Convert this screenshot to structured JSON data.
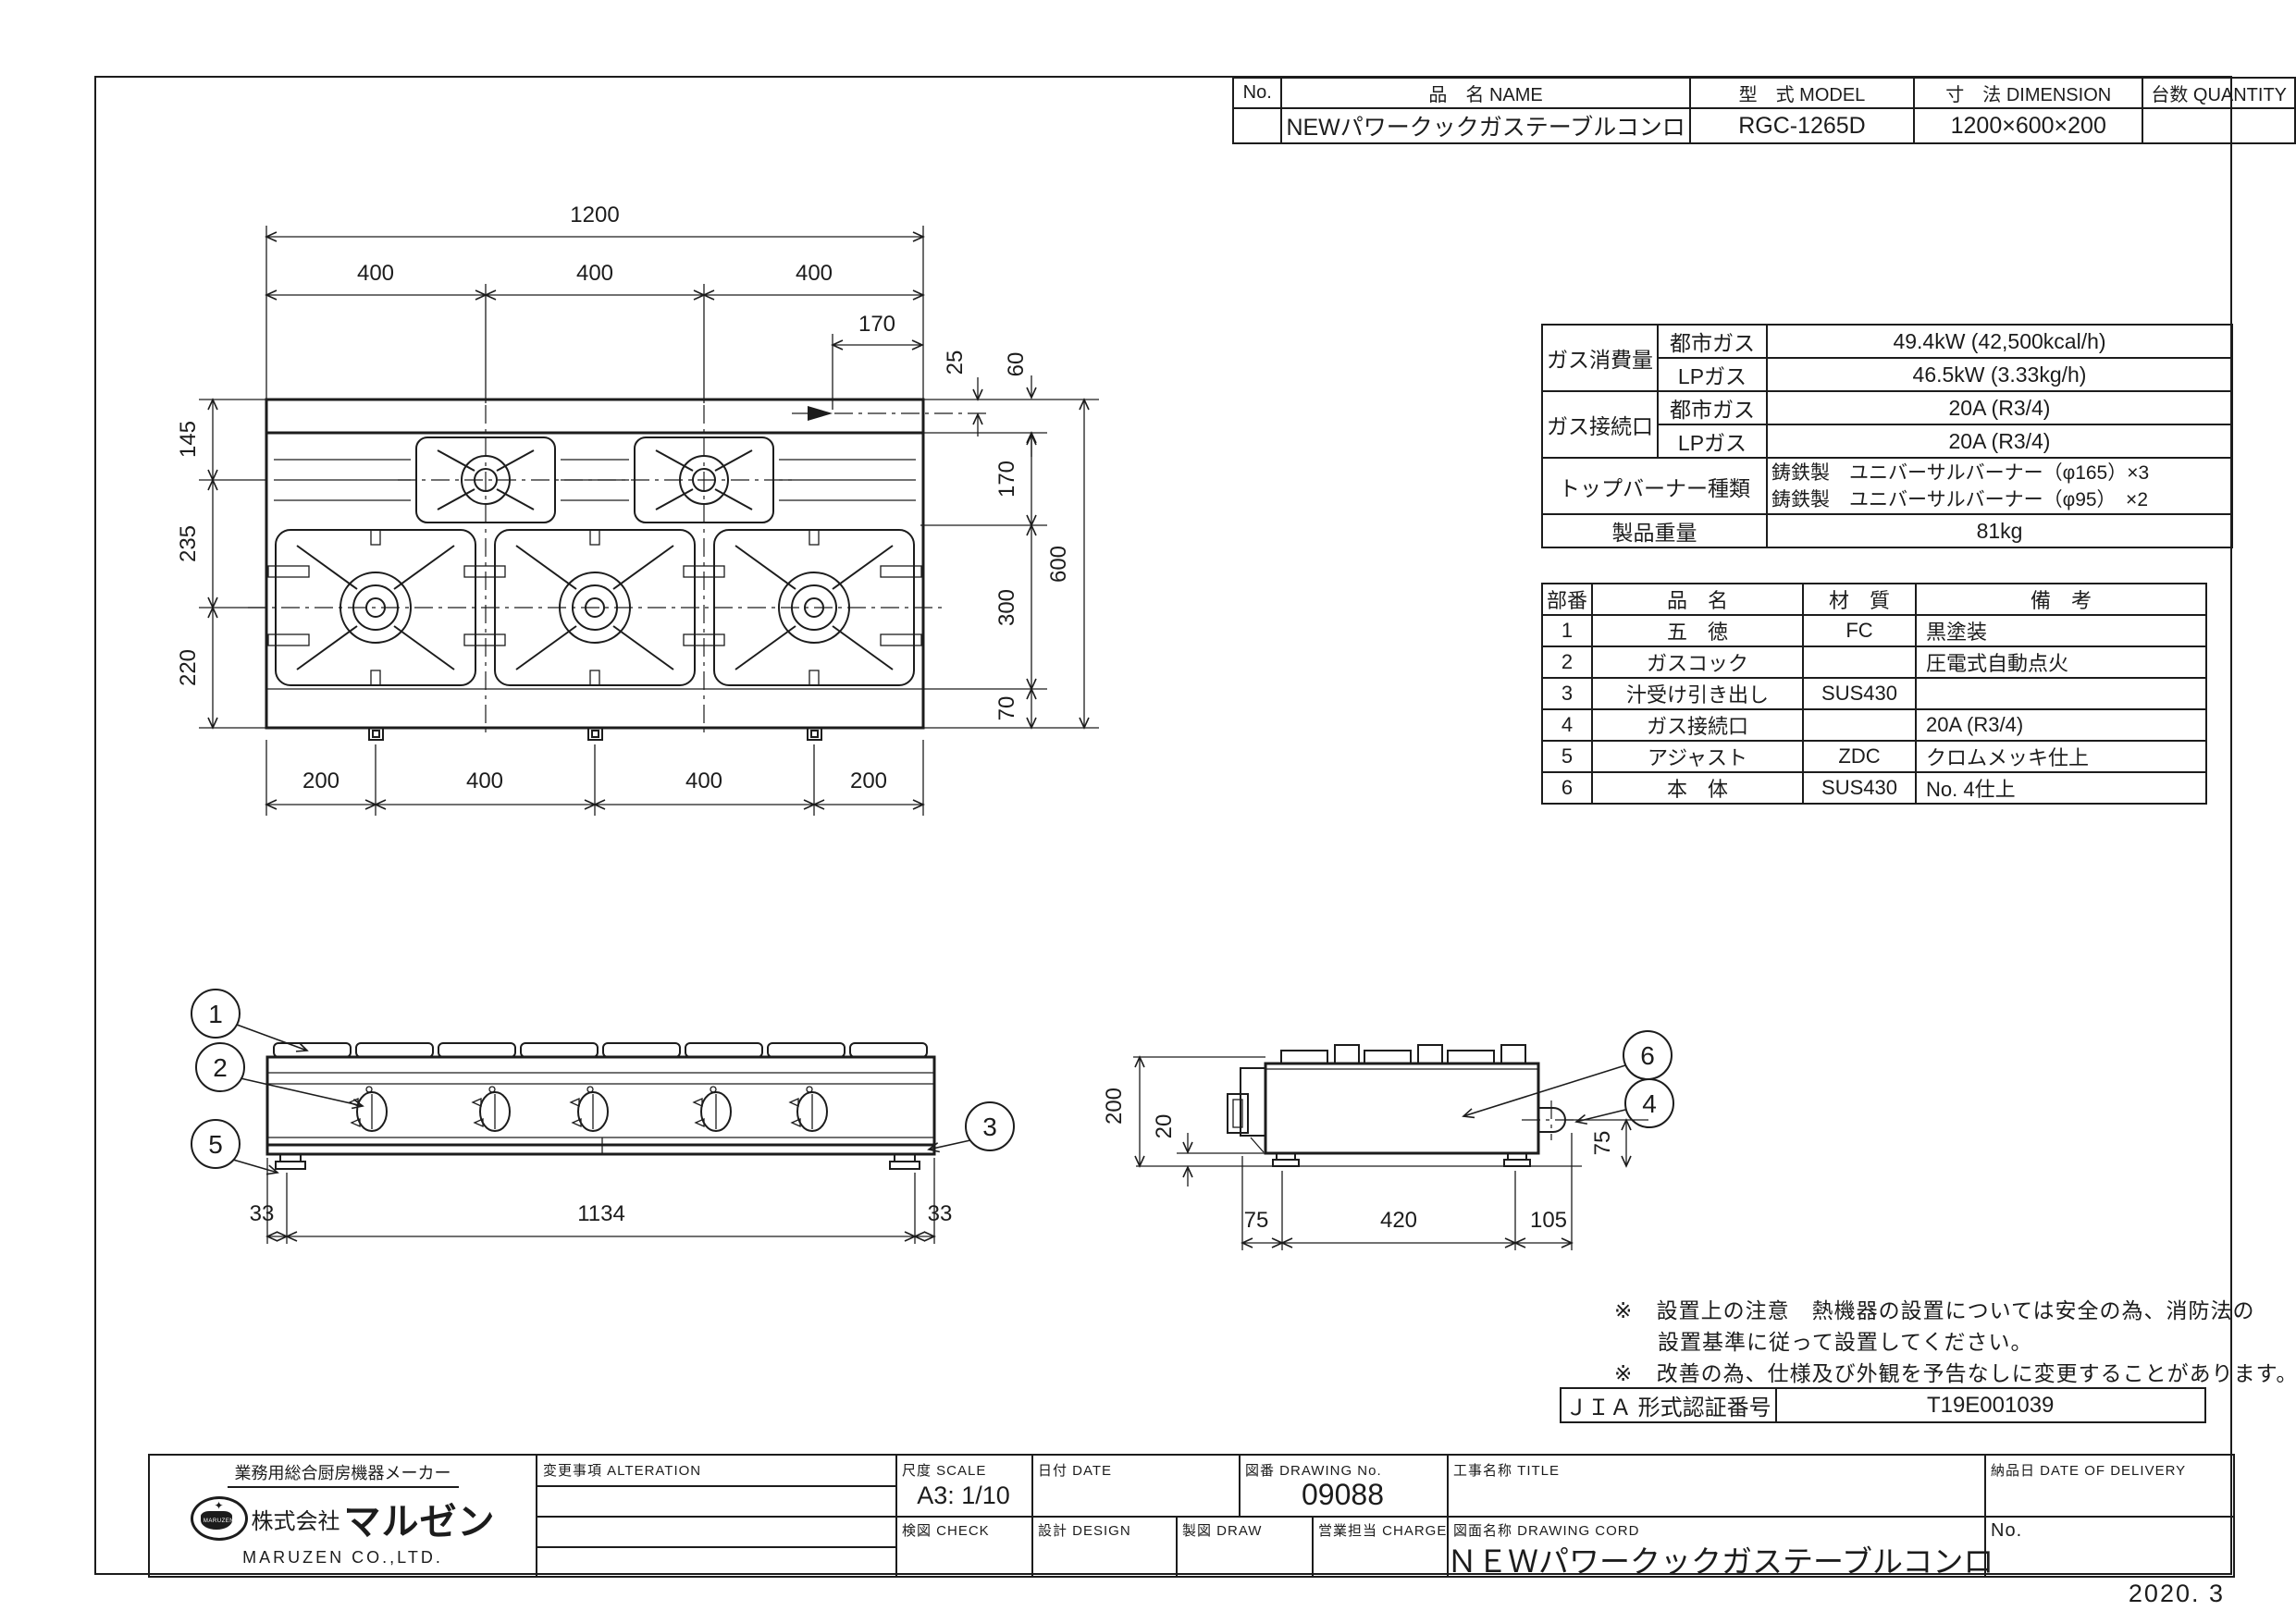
{
  "sheet": {
    "issue_date": "2020. 3"
  },
  "model_table": {
    "no_h": "No.",
    "name_h": "品　名 NAME",
    "model_h": "型　式 MODEL",
    "dim_h": "寸　法 DIMENSION",
    "qty_h": "台数 QUANTITY",
    "name": "NEWパワークックガステーブルコンロ",
    "model": "RGC-1265D",
    "dim": "1200×600×200"
  },
  "spec": {
    "g_consumption": "ガス消費量",
    "g_connection": "ガス接続口",
    "g_burner": "トップバーナー種類",
    "g_weight": "製品重量",
    "city1": "都市ガス",
    "lp1": "LPガス",
    "city2": "都市ガス",
    "lp2": "LPガス",
    "consumption_city": "49.4kW (42,500kcal/h)",
    "consumption_lp": "46.5kW (3.33kg/h)",
    "connection_city": "20A (R3/4)",
    "connection_lp": "20A (R3/4)",
    "burner1": "鋳鉄製　ユニバーサルバーナー（φ165）×3",
    "burner2": "鋳鉄製　ユニバーサルバーナー（φ95）　×2",
    "weight": "81kg"
  },
  "parts": {
    "headers": [
      "部番",
      "品　名",
      "材　質",
      "備　考"
    ],
    "rows": [
      [
        "1",
        "五　徳",
        "FC",
        "黒塗装"
      ],
      [
        "2",
        "ガスコック",
        "",
        "圧電式自動点火"
      ],
      [
        "3",
        "汁受け引き出し",
        "SUS430",
        ""
      ],
      [
        "4",
        "ガス接続口",
        "",
        "20A (R3/4)"
      ],
      [
        "5",
        "アジャスト",
        "ZDC",
        "クロムメッキ仕上"
      ],
      [
        "6",
        "本　体",
        "SUS430",
        "No. 4仕上"
      ]
    ]
  },
  "notes": {
    "mark1": "※",
    "line1": "設置上の注意　熱機器の設置については安全の為、消防法の",
    "line2": "設置基準に従って設置してください。",
    "mark2": "※",
    "line3": "改善の為、仕様及び外観を予告なしに変更することがあります。"
  },
  "jia": {
    "label": "ＪＩＡ 形式認証番号",
    "value": "T19E001039"
  },
  "titleblock": {
    "maker_tagline": "業務用総合厨房機器メーカー",
    "company_prefix": "株式会社",
    "company_name": "マルゼン",
    "company_en": "MARUZEN CO.,LTD.",
    "logo_text": "MARUZEN",
    "alteration": "変更事項  ALTERATION",
    "scale_label": "尺度  SCALE",
    "scale_value": "A3: 1/10",
    "date_label": "日付  DATE",
    "dwgno_label": "図番  DRAWING No.",
    "dwgno_value": "09088",
    "title_label": "工事名称  TITLE",
    "check_label": "検図  CHECK",
    "design_label": "設計  DESIGN",
    "draw_label": "製図  DRAW",
    "charge_label": "営業担当  CHARGE",
    "dwgname_label": "図面名称  DRAWING CORD",
    "dwgname_value": "ＮＥＷパワークックガステーブルコンロ",
    "delivery_label": "納品日  DATE OF DELIVERY",
    "no_label": "No."
  },
  "dims": {
    "plan": {
      "total_w": "1200",
      "seg_w": [
        "400",
        "400",
        "400"
      ],
      "offset170": "170",
      "rot25": "25",
      "rot60": "60",
      "r170": "170",
      "r300": "300",
      "r70": "70",
      "r600": "600",
      "l145": "145",
      "l235": "235",
      "l220": "220",
      "b": [
        "200",
        "400",
        "400",
        "200"
      ]
    },
    "front": {
      "l33": "33",
      "c1134": "1134",
      "r33": "33"
    },
    "side": {
      "h200": "200",
      "h20": "20",
      "r75": "75",
      "b75": "75",
      "b420": "420",
      "b105": "105"
    }
  },
  "callouts": {
    "c1": "1",
    "c2": "2",
    "c3": "3",
    "c4": "4",
    "c5": "5",
    "c6": "6"
  }
}
